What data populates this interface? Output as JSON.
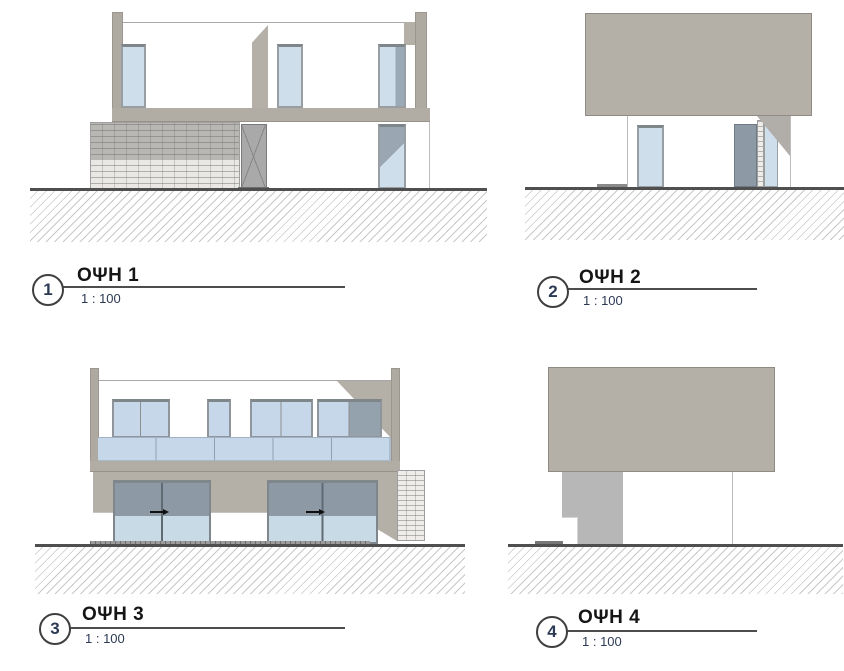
{
  "document": {
    "type": "architectural-elevation-sheet",
    "background": "#ffffff"
  },
  "palette": {
    "wall_gray": "#b4b0a8",
    "wall_edge": "#8f8b84",
    "slab_gray": "#b1ada5",
    "post_gray": "#aeaaa2",
    "pillar_gray": "#b7b7b7",
    "frame_gray": "#989ea1",
    "lintel_gray": "#7f868a",
    "glass_light": "#cfdeeb",
    "glass_mid": "#c6d7e9",
    "glass_shadow": "#8d9aa5",
    "stone_light": "#efede9",
    "ground_line": "#4f4f4f",
    "hatch_line": "#c8c8c8",
    "accent_navy": "#2c3a55"
  },
  "elevations": [
    {
      "number": "1",
      "label": "ΟΨΗ 1",
      "scale": "1 : 100"
    },
    {
      "number": "2",
      "label": "ΟΨΗ 2",
      "scale": "1 : 100"
    },
    {
      "number": "3",
      "label": "ΟΨΗ 3",
      "scale": "1 : 100"
    },
    {
      "number": "4",
      "label": "ΟΨΗ 4",
      "scale": "1 : 100"
    }
  ]
}
